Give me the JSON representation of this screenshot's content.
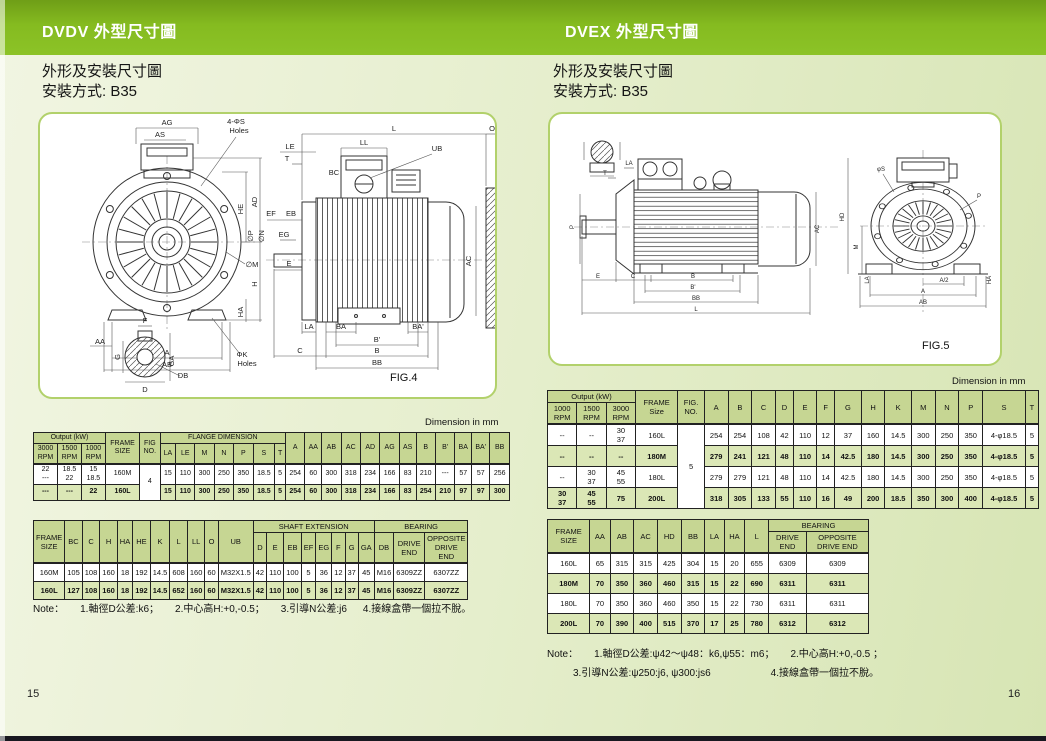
{
  "page": {
    "left_page_number": "15",
    "right_page_number": "16",
    "colors": {
      "band_green": "#85BB20",
      "band_green_dark": "#6F9E17",
      "table_header_bg": "#C6D693",
      "row_shade_bg": "#DBE7B6",
      "figure_border": "#B2D16B",
      "page_bg_light": "#F1F5E2",
      "page_bg_dark": "#D7E5B4",
      "footer_bar": "#181820"
    }
  },
  "left": {
    "band_title": "DVDV  外型尺寸圖",
    "subtitle_line1": "外形及安裝尺寸圖",
    "subtitle_line2": "安裝方式: B35",
    "figure_caption": "FIG.4",
    "dimension_unit_note": "Dimension in mm",
    "table1": {
      "header": [
        [
          {
            "t": "Output (kW)",
            "cs": 3
          },
          {
            "t": "FRAME\nSIZE",
            "rs": 2
          },
          {
            "t": "FIG\nNO.",
            "rs": 2
          },
          {
            "t": "FLANGE DIMENSION",
            "cs": 7
          },
          {
            "t": "A",
            "rs": 2
          },
          {
            "t": "AA",
            "rs": 2
          },
          {
            "t": "AB",
            "rs": 2
          },
          {
            "t": "AC",
            "rs": 2
          },
          {
            "t": "AD",
            "rs": 2
          },
          {
            "t": "AG",
            "rs": 2
          },
          {
            "t": "AS",
            "rs": 2
          },
          {
            "t": "B",
            "rs": 2
          },
          {
            "t": "B'",
            "rs": 2
          },
          {
            "t": "BA",
            "rs": 2
          },
          {
            "t": "BA'",
            "rs": 2
          },
          {
            "t": "BB",
            "rs": 2
          }
        ],
        [
          {
            "t": "3000\nRPM"
          },
          {
            "t": "1500\nRPM"
          },
          {
            "t": "1000\nRPM"
          },
          {
            "t": "LA"
          },
          {
            "t": "LE"
          },
          {
            "t": "M"
          },
          {
            "t": "N"
          },
          {
            "t": "P"
          },
          {
            "t": "S"
          },
          {
            "t": "T"
          }
        ]
      ],
      "rows": [
        [
          "22\n---",
          "18.5\n22",
          "15\n18.5",
          "160M",
          {
            "t": "4",
            "rs": 2
          },
          "15",
          "110",
          "300",
          "250",
          "350",
          "18.5",
          "5",
          "254",
          "60",
          "300",
          "318",
          "234",
          "166",
          "83",
          "210",
          "---",
          "57",
          "57",
          "256"
        ],
        [
          "---",
          "---",
          "22",
          "160L",
          "15",
          "110",
          "300",
          "250",
          "350",
          "18.5",
          "5",
          "254",
          "60",
          "300",
          "318",
          "234",
          "166",
          "83",
          "254",
          "210",
          "97",
          "97",
          "300"
        ]
      ]
    },
    "table2": {
      "header": [
        [
          {
            "t": "FRAME\nSIZE",
            "rs": 2
          },
          {
            "t": "BC",
            "rs": 2
          },
          {
            "t": "C",
            "rs": 2
          },
          {
            "t": "H",
            "rs": 2
          },
          {
            "t": "HA",
            "rs": 2
          },
          {
            "t": "HE",
            "rs": 2
          },
          {
            "t": "K",
            "rs": 2
          },
          {
            "t": "L",
            "rs": 2
          },
          {
            "t": "LL",
            "rs": 2
          },
          {
            "t": "O",
            "rs": 2
          },
          {
            "t": "UB",
            "rs": 2
          },
          {
            "t": "SHAFT  EXTENSION",
            "cs": 8
          },
          {
            "t": "BEARING",
            "cs": 3
          }
        ],
        [
          {
            "t": "D"
          },
          {
            "t": "E"
          },
          {
            "t": "EB"
          },
          {
            "t": "EF"
          },
          {
            "t": "EG"
          },
          {
            "t": "F"
          },
          {
            "t": "G"
          },
          {
            "t": "GA"
          },
          {
            "t": "DB"
          },
          {
            "t": "DRIVE\nEND"
          },
          {
            "t": "OPPOSITE\nDRIVE  END"
          }
        ]
      ],
      "rows": [
        [
          "160M",
          "105",
          "108",
          "160",
          "18",
          "192",
          "14.5",
          "608",
          "160",
          "60",
          "M32X1.5",
          "42",
          "110",
          "100",
          "5",
          "36",
          "12",
          "37",
          "45",
          "M16",
          "6309ZZ",
          "6307ZZ"
        ],
        [
          "160L",
          "127",
          "108",
          "160",
          "18",
          "192",
          "14.5",
          "652",
          "160",
          "60",
          "M32X1.5",
          "42",
          "110",
          "100",
          "5",
          "36",
          "12",
          "37",
          "45",
          "M16",
          "6309ZZ",
          "6307ZZ"
        ]
      ]
    },
    "note": {
      "label": "Note：",
      "items": [
        "1.軸徑D公差:k6；",
        "2.中心高H:+0,-0.5；",
        "3.引導N公差:j6",
        "4.接線盒帶一個拉不脫。"
      ]
    },
    "fig_labels": [
      {
        "t": "AG",
        "x": 127,
        "y": 11
      },
      {
        "t": "AS",
        "x": 120,
        "y": 23
      },
      {
        "t": "4-ΦS",
        "x": 196,
        "y": 10
      },
      {
        "t": "Holes",
        "x": 199,
        "y": 19
      },
      {
        "t": "HE",
        "x": 203,
        "y": 95,
        "r": 1
      },
      {
        "t": "AD",
        "x": 217,
        "y": 88,
        "r": 1
      },
      {
        "t": "∅M",
        "x": 212,
        "y": 153
      },
      {
        "t": "HA",
        "x": 203,
        "y": 198,
        "r": 1
      },
      {
        "t": "H",
        "x": 217,
        "y": 170,
        "r": 1
      },
      {
        "t": "AA",
        "x": 60,
        "y": 230
      },
      {
        "t": "A",
        "x": 127,
        "y": 241
      },
      {
        "t": "AB",
        "x": 127,
        "y": 253
      },
      {
        "t": "ΦK",
        "x": 202,
        "y": 243
      },
      {
        "t": "Holes",
        "x": 207,
        "y": 252
      },
      {
        "t": "F",
        "x": 105,
        "y": 209
      },
      {
        "t": "G",
        "x": 80,
        "y": 243,
        "r": 1
      },
      {
        "t": "GA",
        "x": 134,
        "y": 247,
        "r": 1
      },
      {
        "t": "D",
        "x": 105,
        "y": 278
      },
      {
        "t": "DB",
        "x": 143,
        "y": 264
      },
      {
        "t": "L",
        "x": 354,
        "y": 17
      },
      {
        "t": "O",
        "x": 452,
        "y": 17
      },
      {
        "t": "LL",
        "x": 324,
        "y": 31
      },
      {
        "t": "UB",
        "x": 397,
        "y": 37
      },
      {
        "t": "LE",
        "x": 250,
        "y": 35
      },
      {
        "t": "T",
        "x": 247,
        "y": 47
      },
      {
        "t": "BC",
        "x": 294,
        "y": 61
      },
      {
        "t": "EF",
        "x": 231,
        "y": 102
      },
      {
        "t": "EB",
        "x": 251,
        "y": 102
      },
      {
        "t": "EG",
        "x": 244,
        "y": 123
      },
      {
        "t": "E",
        "x": 249,
        "y": 152
      },
      {
        "t": "∅P",
        "x": 213,
        "y": 122,
        "r": 1
      },
      {
        "t": "∅N",
        "x": 224,
        "y": 122,
        "r": 1
      },
      {
        "t": "LA",
        "x": 269,
        "y": 215
      },
      {
        "t": "BA",
        "x": 301,
        "y": 215
      },
      {
        "t": "BA'",
        "x": 378,
        "y": 215
      },
      {
        "t": "B'",
        "x": 337,
        "y": 228
      },
      {
        "t": "B",
        "x": 337,
        "y": 239
      },
      {
        "t": "C",
        "x": 260,
        "y": 239
      },
      {
        "t": "BB",
        "x": 337,
        "y": 251
      },
      {
        "t": "AC",
        "x": 431,
        "y": 147,
        "r": 1
      }
    ]
  },
  "right": {
    "band_title": "DVEX  外型尺寸圖",
    "subtitle_line1": "外形及安裝尺寸圖",
    "subtitle_line2": "安裝方式: B35",
    "figure_caption": "FIG.5",
    "dimension_unit_note": "Dimension in mm",
    "table1": {
      "header": [
        [
          {
            "t": "Output (kW)",
            "cs": 3
          },
          {
            "t": "FRAME\nSize",
            "rs": 2
          },
          {
            "t": "FIG.\nNO.",
            "rs": 2
          },
          {
            "t": "A",
            "rs": 2
          },
          {
            "t": "B",
            "rs": 2
          },
          {
            "t": "C",
            "rs": 2
          },
          {
            "t": "D",
            "rs": 2
          },
          {
            "t": "E",
            "rs": 2
          },
          {
            "t": "F",
            "rs": 2
          },
          {
            "t": "G",
            "rs": 2
          },
          {
            "t": "H",
            "rs": 2
          },
          {
            "t": "K",
            "rs": 2
          },
          {
            "t": "M",
            "rs": 2
          },
          {
            "t": "N",
            "rs": 2
          },
          {
            "t": "P",
            "rs": 2
          },
          {
            "t": "S",
            "rs": 2
          },
          {
            "t": "T",
            "rs": 2
          }
        ],
        [
          {
            "t": "1000\nRPM"
          },
          {
            "t": "1500\nRPM"
          },
          {
            "t": "3000\nRPM"
          }
        ]
      ],
      "rows": [
        [
          "--",
          "--",
          "30\n37",
          "160L",
          {
            "t": "5",
            "rs": 4
          },
          "254",
          "254",
          "108",
          "42",
          "110",
          "12",
          "37",
          "160",
          "14.5",
          "300",
          "250",
          "350",
          "4-φ18.5",
          "5"
        ],
        [
          "--",
          "--",
          "--",
          "180M",
          "279",
          "241",
          "121",
          "48",
          "110",
          "14",
          "42.5",
          "180",
          "14.5",
          "300",
          "250",
          "350",
          "4-φ18.5",
          "5"
        ],
        [
          "--",
          "30\n37",
          "45\n55",
          "180L",
          "279",
          "279",
          "121",
          "48",
          "110",
          "14",
          "42.5",
          "180",
          "14.5",
          "300",
          "250",
          "350",
          "4-φ18.5",
          "5"
        ],
        [
          "30\n37",
          "45\n55",
          "75",
          "200L",
          "318",
          "305",
          "133",
          "55",
          "110",
          "16",
          "49",
          "200",
          "18.5",
          "350",
          "300",
          "400",
          "4-φ18.5",
          "5"
        ]
      ]
    },
    "table2": {
      "header": [
        [
          {
            "t": "FRAME\nSIZE",
            "rs": 2
          },
          {
            "t": "AA",
            "rs": 2
          },
          {
            "t": "AB",
            "rs": 2
          },
          {
            "t": "AC",
            "rs": 2
          },
          {
            "t": "HD",
            "rs": 2
          },
          {
            "t": "BB",
            "rs": 2
          },
          {
            "t": "LA",
            "rs": 2
          },
          {
            "t": "HA",
            "rs": 2
          },
          {
            "t": "L",
            "rs": 2
          },
          {
            "t": "BEARING",
            "cs": 2
          }
        ],
        [
          {
            "t": "DRIVE\nEND"
          },
          {
            "t": "OPPOSITE\nDRIVE END"
          }
        ]
      ],
      "rows": [
        [
          "160L",
          "65",
          "315",
          "315",
          "425",
          "304",
          "15",
          "20",
          "655",
          "6309",
          "6309"
        ],
        [
          "180M",
          "70",
          "350",
          "360",
          "460",
          "315",
          "15",
          "22",
          "690",
          "6311",
          "6311"
        ],
        [
          "180L",
          "70",
          "350",
          "360",
          "460",
          "350",
          "15",
          "22",
          "730",
          "6311",
          "6311"
        ],
        [
          "200L",
          "70",
          "390",
          "400",
          "515",
          "370",
          "17",
          "25",
          "780",
          "6312",
          "6312"
        ]
      ]
    },
    "note": {
      "label": "Note：",
      "line1": [
        "1.軸徑D公差:ψ42～ψ48：k6,ψ55：m6；",
        "2.中心高H:+0,-0.5 ；"
      ],
      "line2": [
        "3.引導N公差:ψ250:j6, ψ300:js6",
        "4.接線盒帶一個拉不脫。"
      ]
    },
    "fig_labels": [
      {
        "t": "LA",
        "x": 79,
        "y": 51
      },
      {
        "t": "T",
        "x": 55,
        "y": 61
      },
      {
        "t": "P",
        "x": 24,
        "y": 113,
        "r": 1
      },
      {
        "t": "E",
        "x": 48,
        "y": 164
      },
      {
        "t": "C",
        "x": 83,
        "y": 164
      },
      {
        "t": "B",
        "x": 143,
        "y": 164
      },
      {
        "t": "B'",
        "x": 143,
        "y": 175
      },
      {
        "t": "BB",
        "x": 146,
        "y": 186
      },
      {
        "t": "L",
        "x": 146,
        "y": 197
      },
      {
        "t": "AC",
        "x": 269,
        "y": 115,
        "r": 1
      },
      {
        "t": "HD",
        "x": 294,
        "y": 103,
        "r": 1
      },
      {
        "t": "M",
        "x": 308,
        "y": 133,
        "r": 1
      },
      {
        "t": "φS",
        "x": 331,
        "y": 57
      },
      {
        "t": "P",
        "x": 429,
        "y": 84
      },
      {
        "t": "LA",
        "x": 319,
        "y": 166,
        "r": 1
      },
      {
        "t": "HA",
        "x": 441,
        "y": 166,
        "r": 1
      },
      {
        "t": "A/2",
        "x": 394,
        "y": 168
      },
      {
        "t": "A",
        "x": 373,
        "y": 179
      },
      {
        "t": "AB",
        "x": 373,
        "y": 190
      }
    ]
  }
}
